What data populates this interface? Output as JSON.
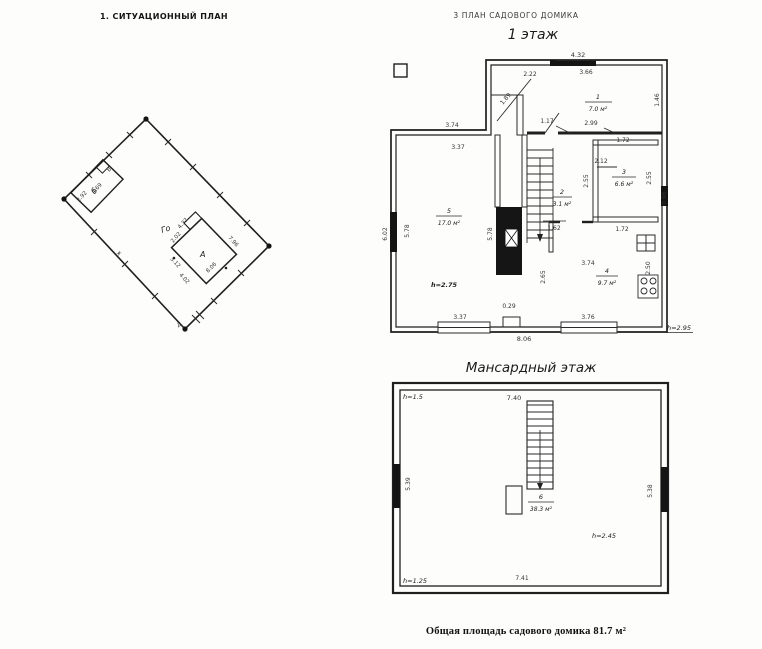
{
  "header": {
    "site_title": "1. СИТУАЦИОННЫЙ ПЛАН",
    "plan_title": "3 ПЛАН САДОВОГО ДОМИКА",
    "floor1_title": "1 этаж",
    "attic_title": "Мансардный этаж"
  },
  "site_plan": {
    "building_main": "А",
    "building_small": "б",
    "label_go": "Го",
    "label_v": "В",
    "label_zh": "ж",
    "label_d": "Д",
    "dims": {
      "b_width": "2.92",
      "b_length": "4.69",
      "a_nw": "4.37",
      "a_porch": "2.02",
      "a_sw1": "3.12",
      "a_sw2": "4.02",
      "a_se": "8.06",
      "a_ne": "7.96"
    }
  },
  "floor1": {
    "rooms": {
      "r1": {
        "num": "1",
        "area": "7.0 м²"
      },
      "r2": {
        "num": "2",
        "area": "3.1 м²"
      },
      "r3": {
        "num": "3",
        "area": "6.6 м²"
      },
      "r4": {
        "num": "4",
        "area": "9.7 м²"
      },
      "r5": {
        "num": "5",
        "area": "17.0 м²"
      }
    },
    "heights": {
      "room5": "h=2.75",
      "floor": "h=2.95"
    },
    "dims": {
      "top_overall": "4.32",
      "top_inner": "3.66",
      "top_small": "2.22",
      "entry_door": "1.89",
      "room1_right": "1.46",
      "upper_wall": "3.74",
      "room5_top": "3.37",
      "door_room1": "1.17",
      "room1_bottom": "2.99",
      "room3_top": "1.72",
      "room3_shelf": "2.12",
      "room3_left": "2.55",
      "wall_right": "2.55",
      "window_right": "0.96",
      "hall_door": "1.62",
      "room3_bottom": "1.72",
      "room4_top": "3.74",
      "room4_left": "2.65",
      "kitchen": "2.50",
      "left_outer": "6.02",
      "left_inner": "5.78",
      "mid_wall": "5.78",
      "notch": "0.29",
      "bottom_left": "3.37",
      "bottom_right": "3.76",
      "bottom_overall": "8.06"
    }
  },
  "attic": {
    "room": {
      "num": "6",
      "area": "38.3 м²"
    },
    "heights": {
      "top_left": "h=1.5",
      "ceiling": "h=2.45",
      "bottom_left": "h=1.25"
    },
    "dims": {
      "stairs": "7.40",
      "left": "5.39",
      "right": "5.38",
      "bottom": "7.41"
    }
  },
  "footer": {
    "total_area": "Общая площадь садового домика 81.7 м²"
  }
}
